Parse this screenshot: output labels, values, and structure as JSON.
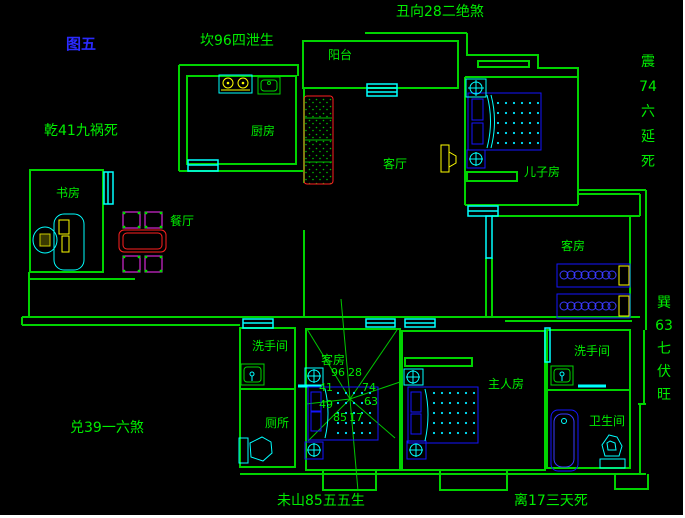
{
  "figure": {
    "label": "图五"
  },
  "fengshui_annotations": {
    "kan": "坎96四泄生",
    "chou": "丑向28二绝煞",
    "qian": "乾41九祸死",
    "zhen_vertical": "震74六延死",
    "xun_vertical": "巽63七伏旺",
    "dui": "兑39一六煞",
    "wei": "未山85五五生",
    "li": "离17三天死"
  },
  "rooms": {
    "kitchen": "厨房",
    "balcony": "阳台",
    "living_room": "客厅",
    "sons_room": "儿子房",
    "guest_room_right": "客房",
    "study": "书房",
    "dining_room": "餐厅",
    "washroom_left": "洗手间",
    "toilet": "厕所",
    "guest_room_middle": "客房",
    "master_bedroom": "主人房",
    "washroom_right": "洗手间",
    "bathroom": "卫生间"
  },
  "compass_numbers": {
    "top_left": "96",
    "top_right": "28",
    "left_upper": "41",
    "right_upper": "74",
    "left_lower": "49",
    "right_lower": "63",
    "bottom_left": "85",
    "bottom_right": "17"
  },
  "colors": {
    "background": "#000000",
    "wall_green": "#00D400",
    "text_green": "#00EE00",
    "figure_blue": "#2A2AFF",
    "furniture_blue": "#1414FF",
    "window_cyan": "#00FFFF",
    "sofa_red": "#FF2020",
    "accent_yellow": "#FFFF00",
    "chair_magenta": "#FF30FF",
    "scrollbar_white": "#FFFFFF"
  }
}
